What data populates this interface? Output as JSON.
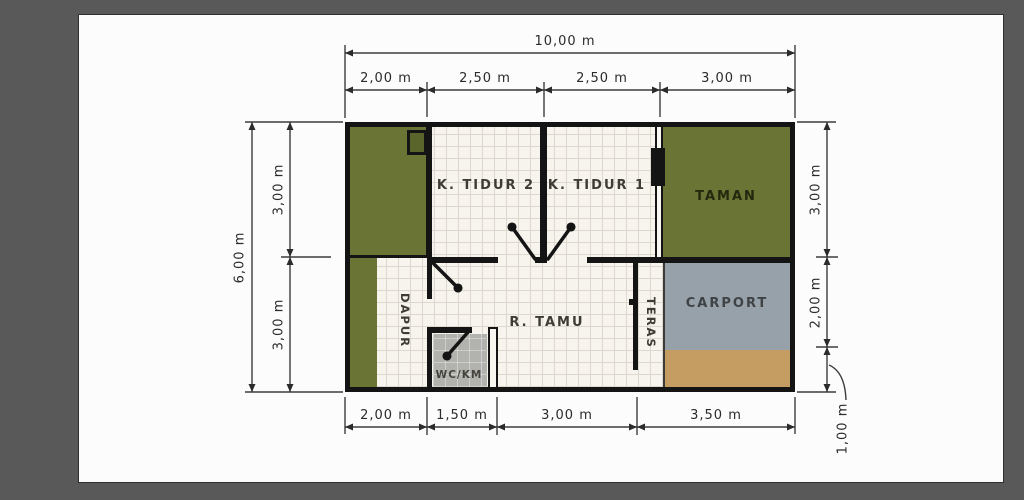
{
  "window": {
    "surround_color": "#595959",
    "canvas_color": "#fcfcfc"
  },
  "floorplan": {
    "rooms": {
      "k_tidur_2": "K. TIDUR 2",
      "k_tidur_1": "K. TIDUR 1",
      "taman": "TAMAN",
      "carport": "CARPORT",
      "r_tamu": "R. TAMU",
      "dapur": "DAPUR",
      "teras": "TERAS",
      "wc_km": "WC/KM"
    },
    "colors": {
      "garden_green": "#6a7434",
      "carport_gray": "#97a1a9",
      "paving_tan": "#c59c62",
      "wc_gray": "#b2b2af",
      "tile": "#f7f4ee",
      "wall": "#141414"
    }
  },
  "dimensions": {
    "top_total": "10,00 m",
    "top_segments": [
      "2,00 m",
      "2,50 m",
      "2,50 m",
      "3,00 m"
    ],
    "bottom_segments": [
      "2,00 m",
      "1,50 m",
      "3,00 m",
      "3,50 m"
    ],
    "left_total": "6,00 m",
    "left_segments": [
      "3,00 m",
      "3,00 m"
    ],
    "right_segments": [
      "3,00 m",
      "2,00 m",
      "1,00 m"
    ]
  }
}
